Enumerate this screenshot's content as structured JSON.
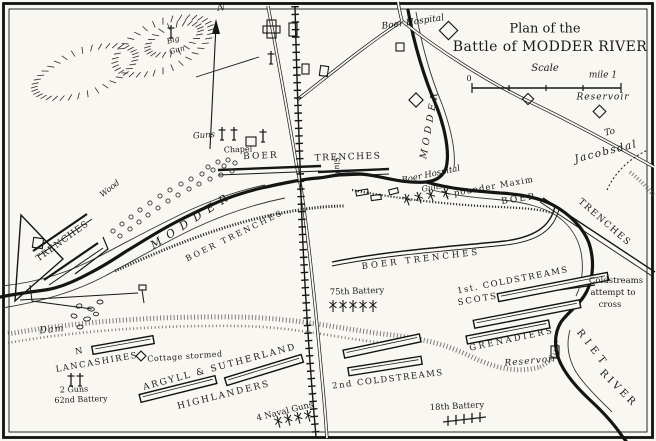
{
  "colors": {
    "ink": "#1a1a1a",
    "paper": "#f9f7f1"
  },
  "title": {
    "line1": "Plan of the",
    "line2": "Battle of MODDER RIVER"
  },
  "scale": {
    "label": "Scale",
    "start": "0",
    "end": "mile 1"
  },
  "compass": {
    "north": "N"
  },
  "labels": {
    "reservoir_n": "Reservoir",
    "to_word": "To",
    "jacobsdal": "Jacobsdal",
    "big_gun_1": "Big",
    "big_gun_2": "Gun",
    "guns_nw": "Guns",
    "chapel": "Chapel",
    "boer_nw": "BOER",
    "trenches_n": "TRENCHES",
    "wood": "Wood",
    "trenches_w": "TRENCHES",
    "modder_w": "MODDER",
    "boer_trenches_w": "BOER TRENCHES",
    "boer_hospital_n": "Boer Hospital",
    "modder_n": "MODDER",
    "sluit": "Sluit",
    "boer_hospital_s": "Boer Hospital",
    "guns_s": "Guns",
    "maxim": "1 pounder Maxim",
    "boer_e": "BOER",
    "trenches_e": "TRENCHES",
    "boer_trenches_m": "BOER TRENCHES",
    "attempt_1": "Coldstreams",
    "attempt_2": "attempt to",
    "attempt_3": "cross",
    "riet": "RIET",
    "river": "RIVER",
    "coldstreams_1": "1st. COLDSTREAMS",
    "scots": "SCOTS",
    "grenadiers": "GRENADIERS",
    "reservoir_s": "Reservoir",
    "battery_18": "18th Battery",
    "coldstreams_2": "2nd COLDSTREAMS",
    "battery_75": "75th Battery",
    "naval_guns": "4 Naval Guns",
    "argyll": "ARGYLL & SUTHERLAND",
    "highlanders": "HIGHLANDERS",
    "cottage": "Cottage stormed",
    "lanc_n": "N",
    "lancashires": "LANCASHIRES",
    "guns_2": "2 Guns",
    "battery_62": "62nd Battery",
    "dam": "Dam"
  }
}
